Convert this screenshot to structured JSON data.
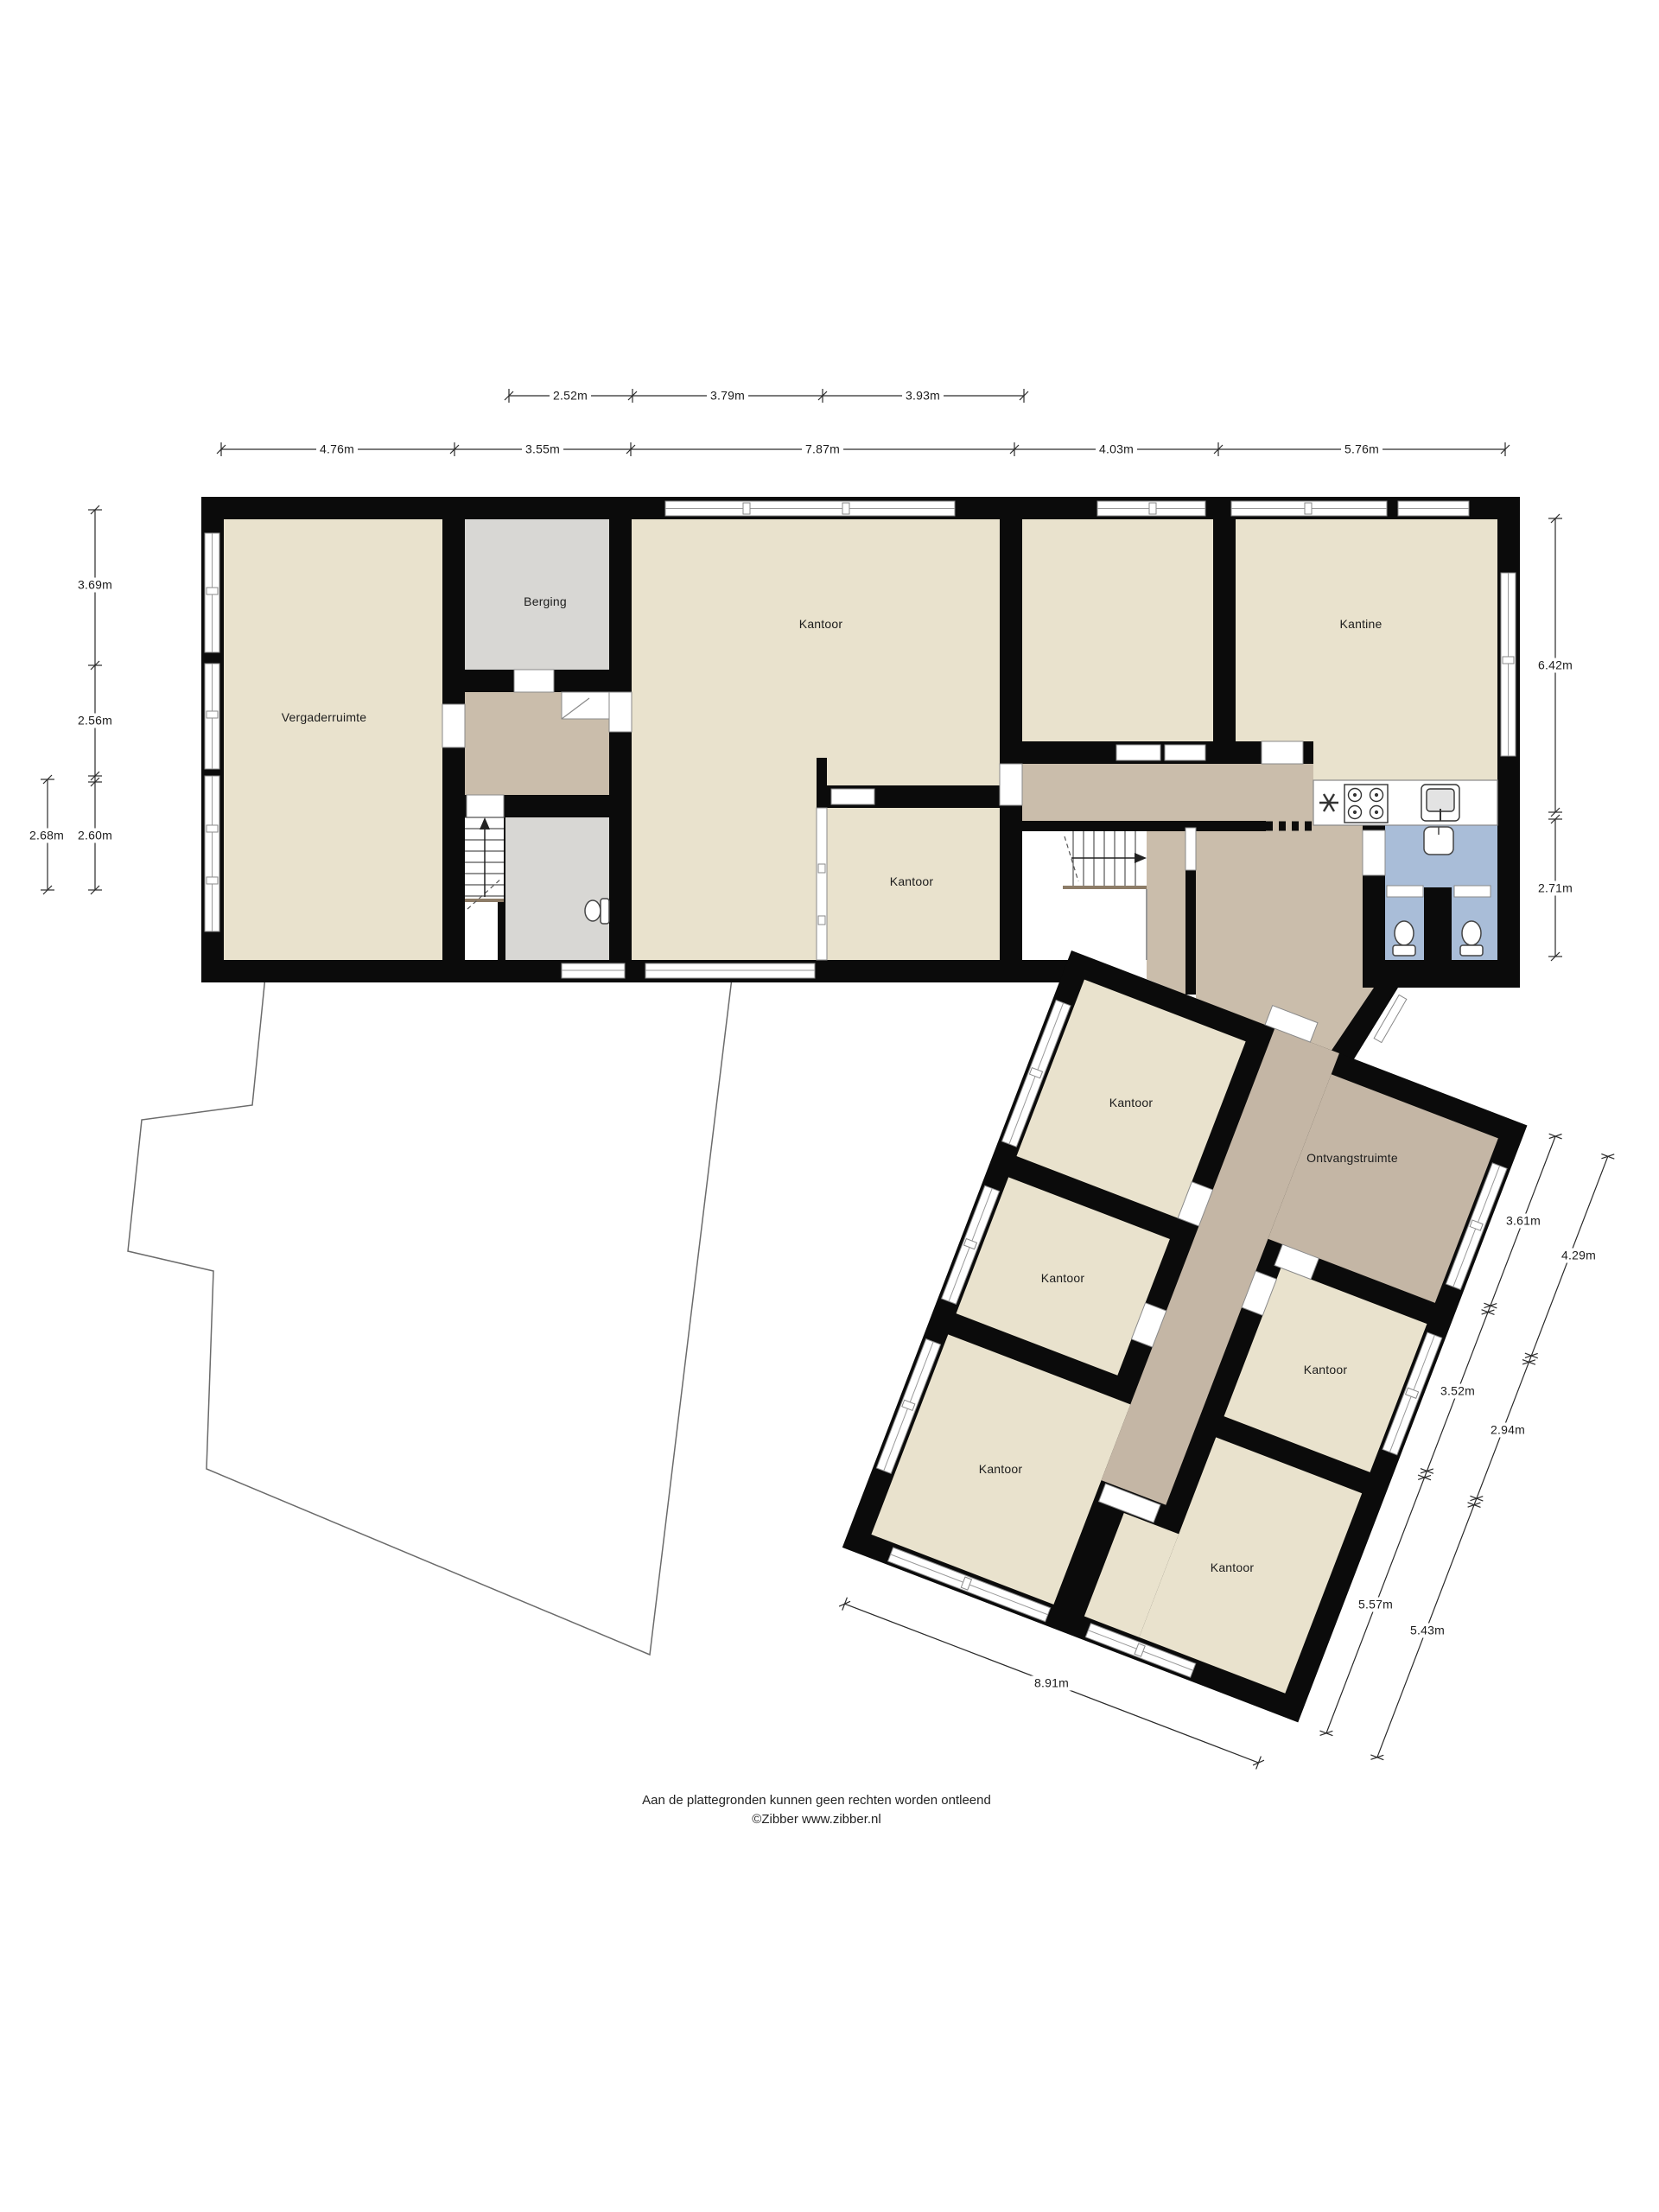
{
  "document": {
    "kind": "floor-plan",
    "footer": {
      "line1": "Aan de plattegronden kunnen geen rechten worden ontleend",
      "line2": "©Zibber www.zibber.nl"
    }
  },
  "rooms": [
    {
      "id": "vergaderruimte",
      "label": "Vergaderruimte"
    },
    {
      "id": "berging",
      "label": "Berging"
    },
    {
      "id": "kantoor-groot",
      "label": "Kantoor"
    },
    {
      "id": "kantine",
      "label": "Kantine"
    },
    {
      "id": "kantoor-klein",
      "label": "Kantoor"
    },
    {
      "id": "kantoor-noord",
      "label": "Kantoor"
    },
    {
      "id": "ontvangstruimte",
      "label": "Ontvangstruimte"
    },
    {
      "id": "kantoor-west",
      "label": "Kantoor"
    },
    {
      "id": "kantoor-oost",
      "label": "Kantoor"
    },
    {
      "id": "kantoor-zuidwest",
      "label": "Kantoor"
    },
    {
      "id": "kantoor-zuid",
      "label": "Kantoor"
    }
  ],
  "dimensions": {
    "top_inner": [
      "2.52m",
      "3.79m",
      "3.93m"
    ],
    "top_outer": [
      "4.76m",
      "3.55m",
      "7.87m",
      "4.03m",
      "5.76m"
    ],
    "left_inner": [
      "3.69m",
      "2.56m",
      "2.60m"
    ],
    "left_outer": [
      "2.68m"
    ],
    "right": [
      "6.42m",
      "2.71m"
    ],
    "annex_inner": [
      "3.61m",
      "3.52m",
      "5.57m"
    ],
    "annex_outer": [
      "4.29m",
      "2.94m",
      "5.43m"
    ],
    "annex_bottom": [
      "8.91m"
    ]
  },
  "icons": {
    "fridge": "✳",
    "stairs_direction_main": "up-arrow",
    "stairs_direction_entry": "right-arrow"
  },
  "colors": {
    "wall": "#0b0b0b",
    "room_beige": "#e9e2cd",
    "room_grey": "#d8d7d4",
    "hall_taupe": "#cabdab",
    "reception_taupe": "#c4b6a5",
    "bathroom_blue": "#a9bdd8",
    "dimension_line": "#2a2a2a"
  }
}
